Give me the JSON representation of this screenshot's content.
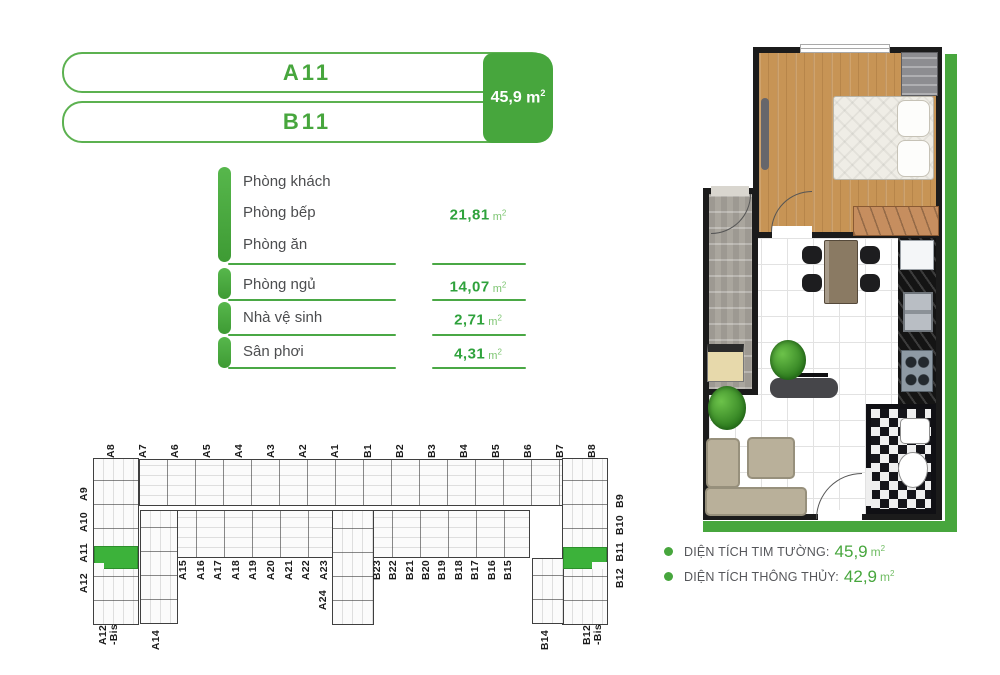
{
  "header": {
    "unit_a": "A11",
    "unit_b": "B11",
    "area_value": "45,9",
    "unit_base": "m",
    "unit_exp": "2"
  },
  "rooms": {
    "group": {
      "labels": [
        "Phòng khách",
        "Phòng bếp",
        "Phòng ăn"
      ],
      "value": "21,81"
    },
    "rows": [
      {
        "label": "Phòng ngủ",
        "value": "14,07"
      },
      {
        "label": "Nhà vệ sinh",
        "value": "2,71"
      },
      {
        "label": "Sân phơi",
        "value": "4,31"
      }
    ],
    "unit_base": "m",
    "unit_exp": "2"
  },
  "site_plan": {
    "top_labels": [
      "A8",
      "A7",
      "A6",
      "A5",
      "A4",
      "A3",
      "A2",
      "A1",
      "B1",
      "B2",
      "B3",
      "B4",
      "B5",
      "B6",
      "B7",
      "B8"
    ],
    "left_labels": [
      "A9",
      "A10",
      "A11",
      "A12"
    ],
    "right_labels": [
      "B9",
      "B10",
      "B11",
      "B12"
    ],
    "mid_labels_a": [
      "A15",
      "A16",
      "A17",
      "A18",
      "A19",
      "A20",
      "A21",
      "A22",
      "A23"
    ],
    "mid_label_a24": "A24",
    "mid_labels_b": [
      "B23",
      "B22",
      "B21",
      "B20",
      "B19",
      "B18",
      "B17",
      "B16",
      "B15"
    ],
    "bottom_label_a12bis": "A12\n-Bis",
    "bottom_label_a14": "A14",
    "bottom_label_b14": "B14",
    "bottom_label_b12bis": "B12\n-Bis",
    "highlighted_units": [
      "A11",
      "B11"
    ]
  },
  "legend": {
    "items": [
      {
        "label": "DIỆN TÍCH TIM TƯỜNG:",
        "value": "45,9"
      },
      {
        "label": "DIỆN TÍCH THÔNG THỦY:",
        "value": "42,9"
      }
    ],
    "unit_base": "m",
    "unit_exp": "2"
  },
  "colors": {
    "primary_green": "#47a63d",
    "highlight_green": "#3cb23a",
    "value_green": "#2fa23c",
    "text_dark": "#4c4d4f",
    "legend_text": "#55565a",
    "plan_wall": "#1b1b1b"
  }
}
